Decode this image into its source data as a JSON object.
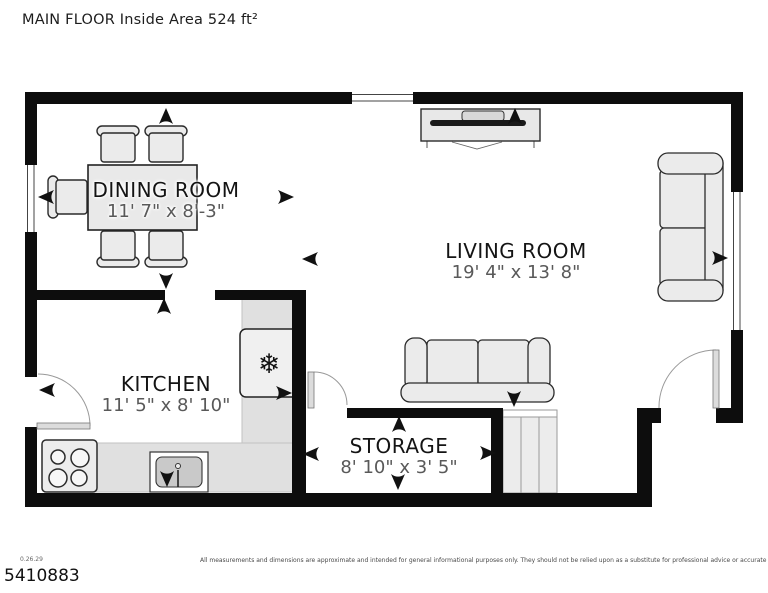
{
  "title": "MAIN FLOOR Inside Area 524 ft²",
  "rooms": [
    {
      "name": "DINING ROOM",
      "dims": "11' 7\" x 8'-3\""
    },
    {
      "name": "LIVING ROOM",
      "dims": "19' 4\" x 13' 8\""
    },
    {
      "name": "KITCHEN",
      "dims": "11' 5\" x 8' 10\""
    },
    {
      "name": "STORAGE",
      "dims": "8' 10\" x 3' 5\""
    }
  ],
  "footer": {
    "version": "0.26.29",
    "plan_number": "5410883",
    "disclaimer": "All measurements and dimensions are approximate and intended for general informational purposes only. They should not be relied upon as a substitute for professional advice or accurate surveying."
  },
  "icons": {
    "snowflake": "❄",
    "direction_arrow": "concave-triangle-arrowhead"
  },
  "colors": {
    "wall": "#0d0d0d",
    "furniture_fill": "#ebebeb",
    "furniture_stroke": "#2b2b2b",
    "counter": "#e0e0e0",
    "room_name_text": "#141414",
    "room_dims_text": "#595959"
  }
}
